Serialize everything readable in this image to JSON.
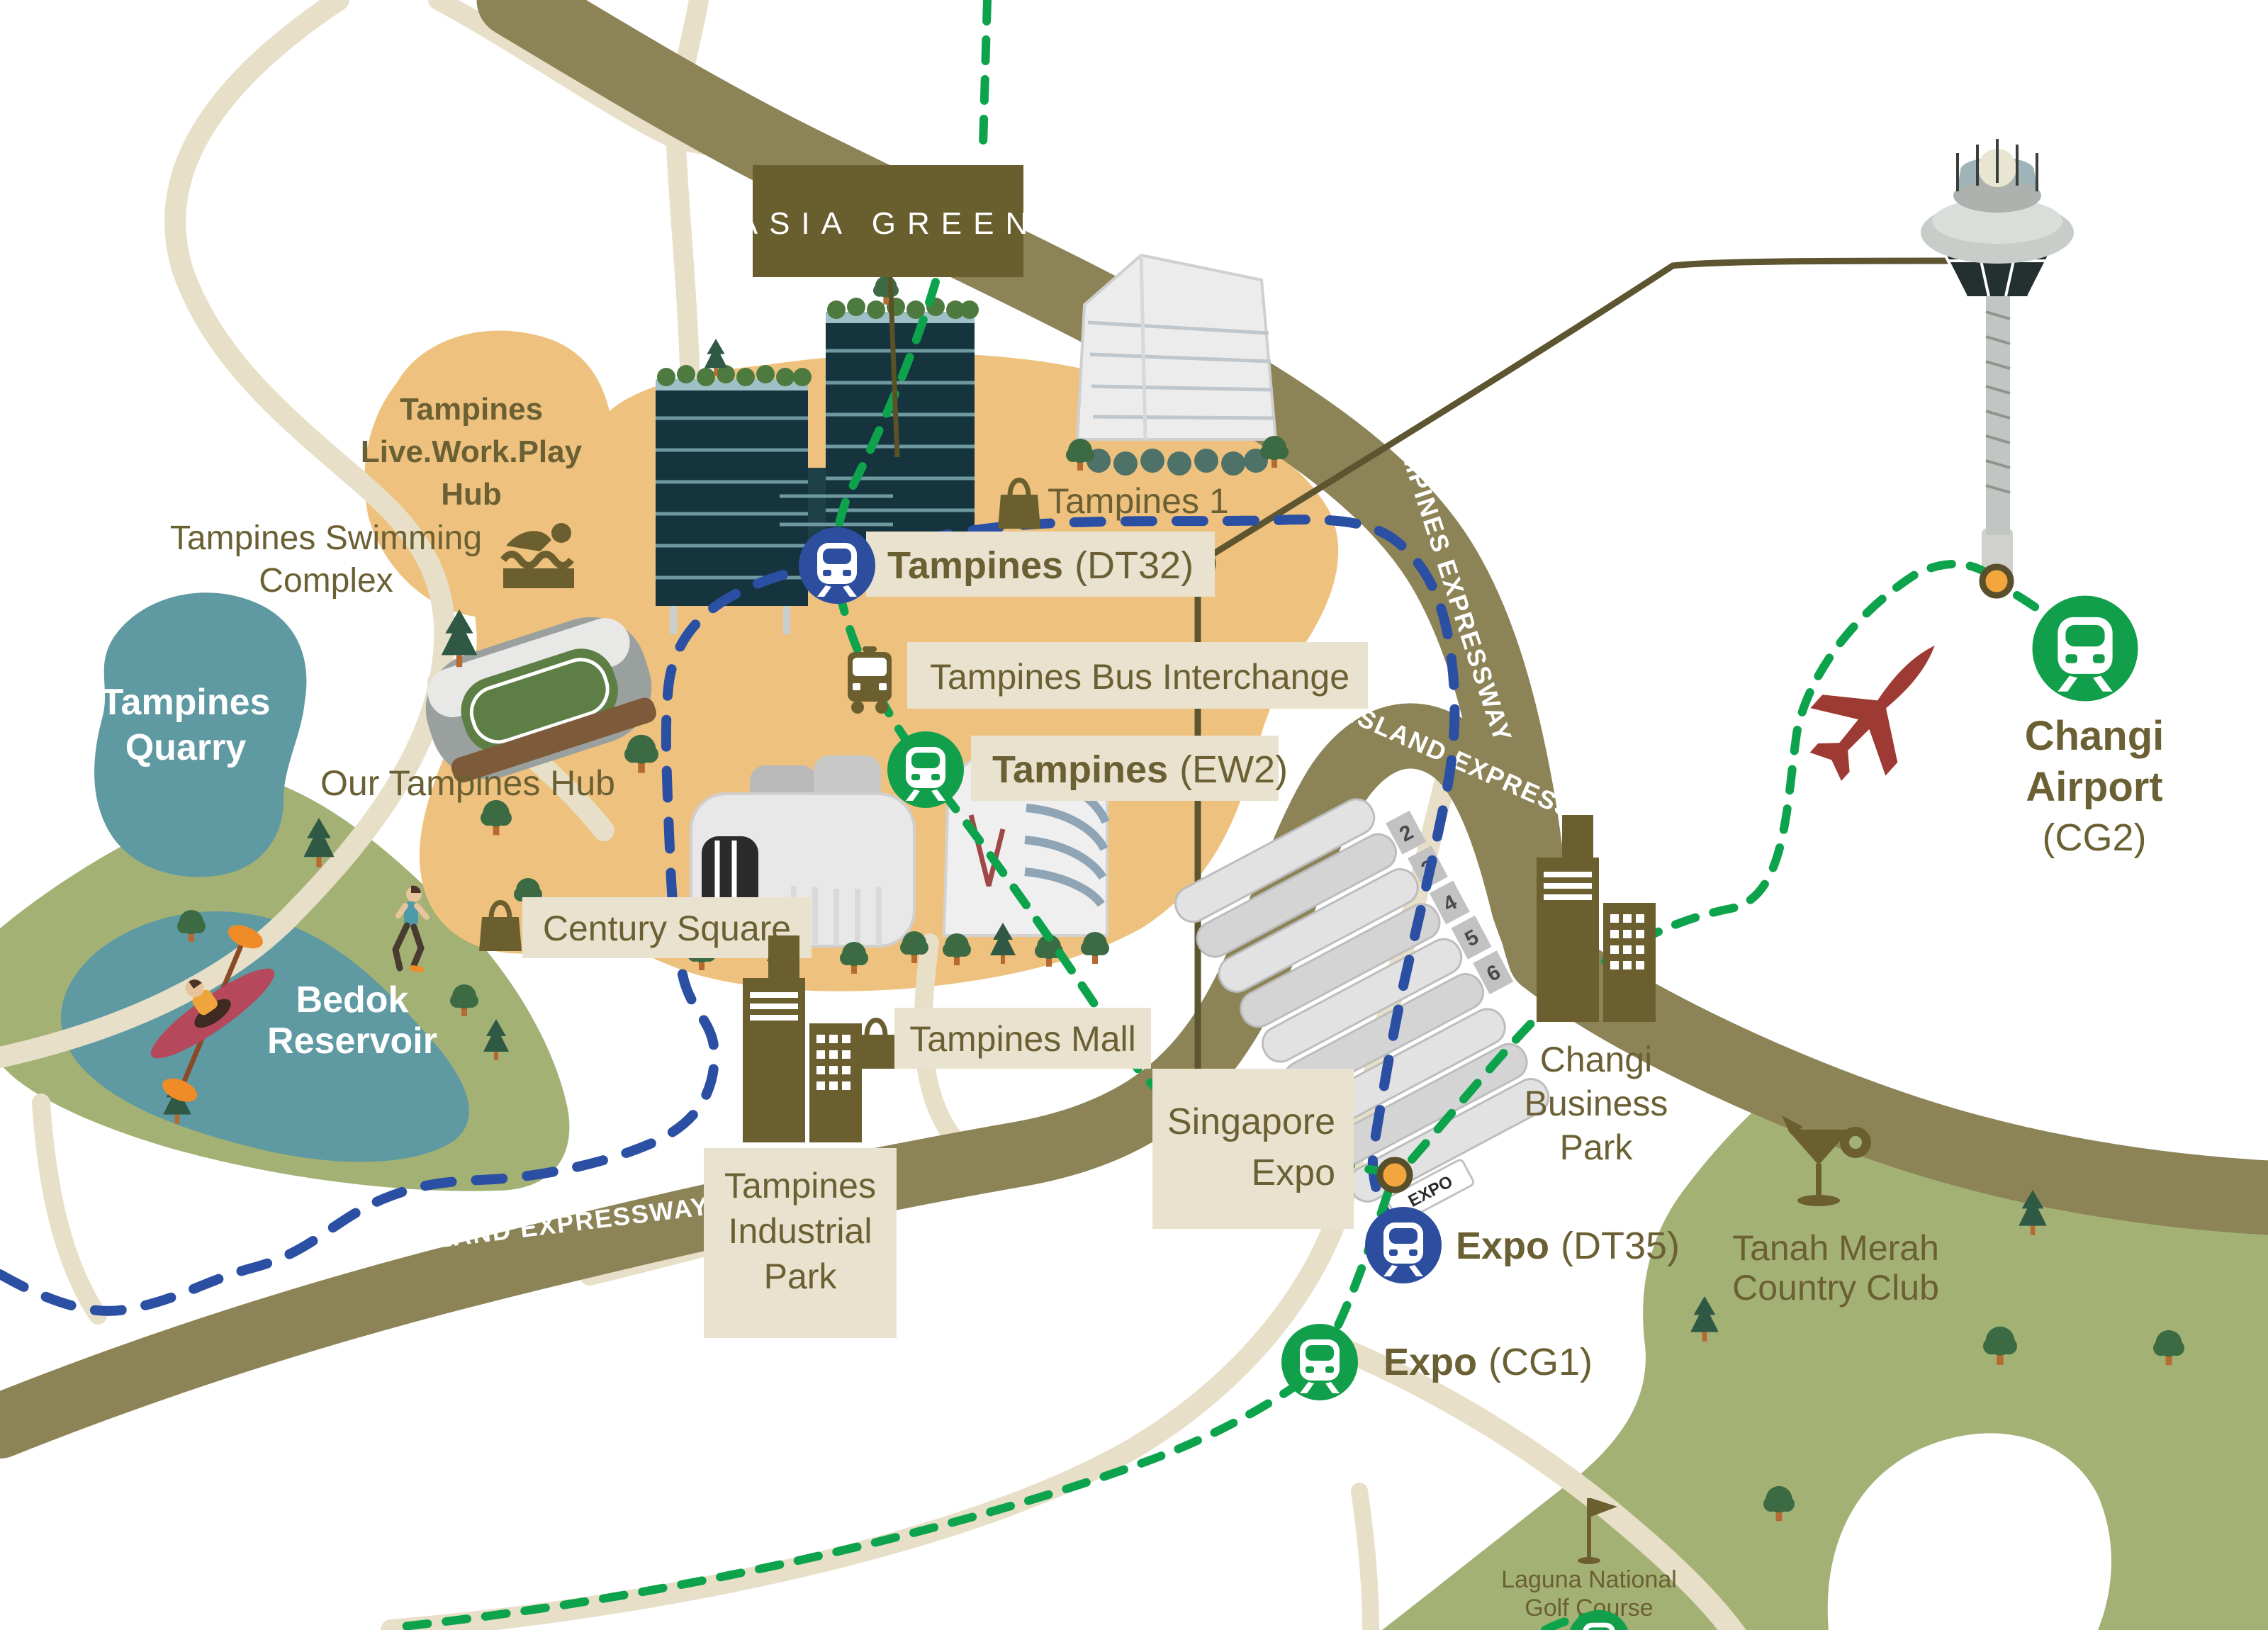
{
  "brand": {
    "banner": "ASIA GREEN"
  },
  "colors": {
    "background": "#ffffff",
    "label_text": "#6b6033",
    "label_box": "#e9e2ce",
    "banner_brown": "#695e2e",
    "road_light": "#e7dfc8",
    "road_expressway": "#8c8357",
    "route_line": "#5d5430",
    "district_orange": "#eec27e",
    "water_teal": "#5f99a2",
    "park_green": "#a4b175",
    "mrt_blue": "#2d4d9e",
    "mrt_green": "#129f4c",
    "dash_blue": "#2b4fa2",
    "dash_green": "#0da34c",
    "station_dot_orange": "#f4a63e",
    "plane_red": "#9d3a33",
    "tower_dark_teal": "#16343d"
  },
  "labels": {
    "live_work_play": {
      "lines": [
        "Tampines",
        "Live.Work.Play",
        "Hub"
      ]
    },
    "swimming": {
      "lines": [
        "Tampines Swimming",
        "Complex"
      ]
    },
    "quarry": {
      "lines": [
        "Tampines",
        "Quarry"
      ]
    },
    "our_tampines_hub": {
      "text": "Our Tampines Hub"
    },
    "bedok": {
      "lines": [
        "Bedok",
        "Reservoir"
      ]
    },
    "tampines1": {
      "text": "Tampines 1"
    },
    "dt32": {
      "name": "Tampines",
      "code": "(DT32)"
    },
    "bus_interchange": {
      "text": "Tampines Bus Interchange"
    },
    "ew2": {
      "name": "Tampines",
      "code": "(EW2)"
    },
    "century_square": {
      "text": "Century Square"
    },
    "tampines_mall": {
      "text": "Tampines Mall"
    },
    "industrial": {
      "lines": [
        "Tampines",
        "Industrial",
        "Park"
      ]
    },
    "singapore_expo": {
      "lines": [
        "Singapore",
        "Expo"
      ]
    },
    "changi_business_park": {
      "lines": [
        "Changi",
        "Business",
        "Park"
      ]
    },
    "dt35": {
      "name": "Expo",
      "code": "(DT35)"
    },
    "cg1": {
      "name": "Expo",
      "code": "(CG1)"
    },
    "changi_airport": {
      "name_lines": [
        "Changi",
        "Airport"
      ],
      "code": "(CG2)"
    },
    "tanah_merah": {
      "lines": [
        "Tanah Merah",
        "Country Club"
      ]
    },
    "laguna": {
      "lines": [
        "Laguna National",
        "Golf Course"
      ]
    },
    "pie_west": {
      "text": "PAN ISLAND EXPRESSWAY"
    },
    "pie_east": {
      "text": "PAN ISLAND EXPRESSWAY"
    },
    "tpe": {
      "text": "TAMPINES EXPRESSWAY"
    },
    "century_building_sign": {
      "lines": [
        "CENTURY",
        "SQUARE"
      ]
    },
    "expo_sign": {
      "text": "EXPO"
    },
    "expo_halls": [
      "2",
      "3",
      "4",
      "5",
      "6"
    ]
  },
  "icons": [
    "mrt-train-icon",
    "bus-icon",
    "shopping-bag-icon",
    "swimmer-icon",
    "cocktail-icon",
    "golf-flag-icon",
    "airplane-icon",
    "control-tower-icon",
    "office-towers-icon",
    "tree-icon",
    "kayaker-icon",
    "runner-icon",
    "interchange-dot-icon"
  ]
}
